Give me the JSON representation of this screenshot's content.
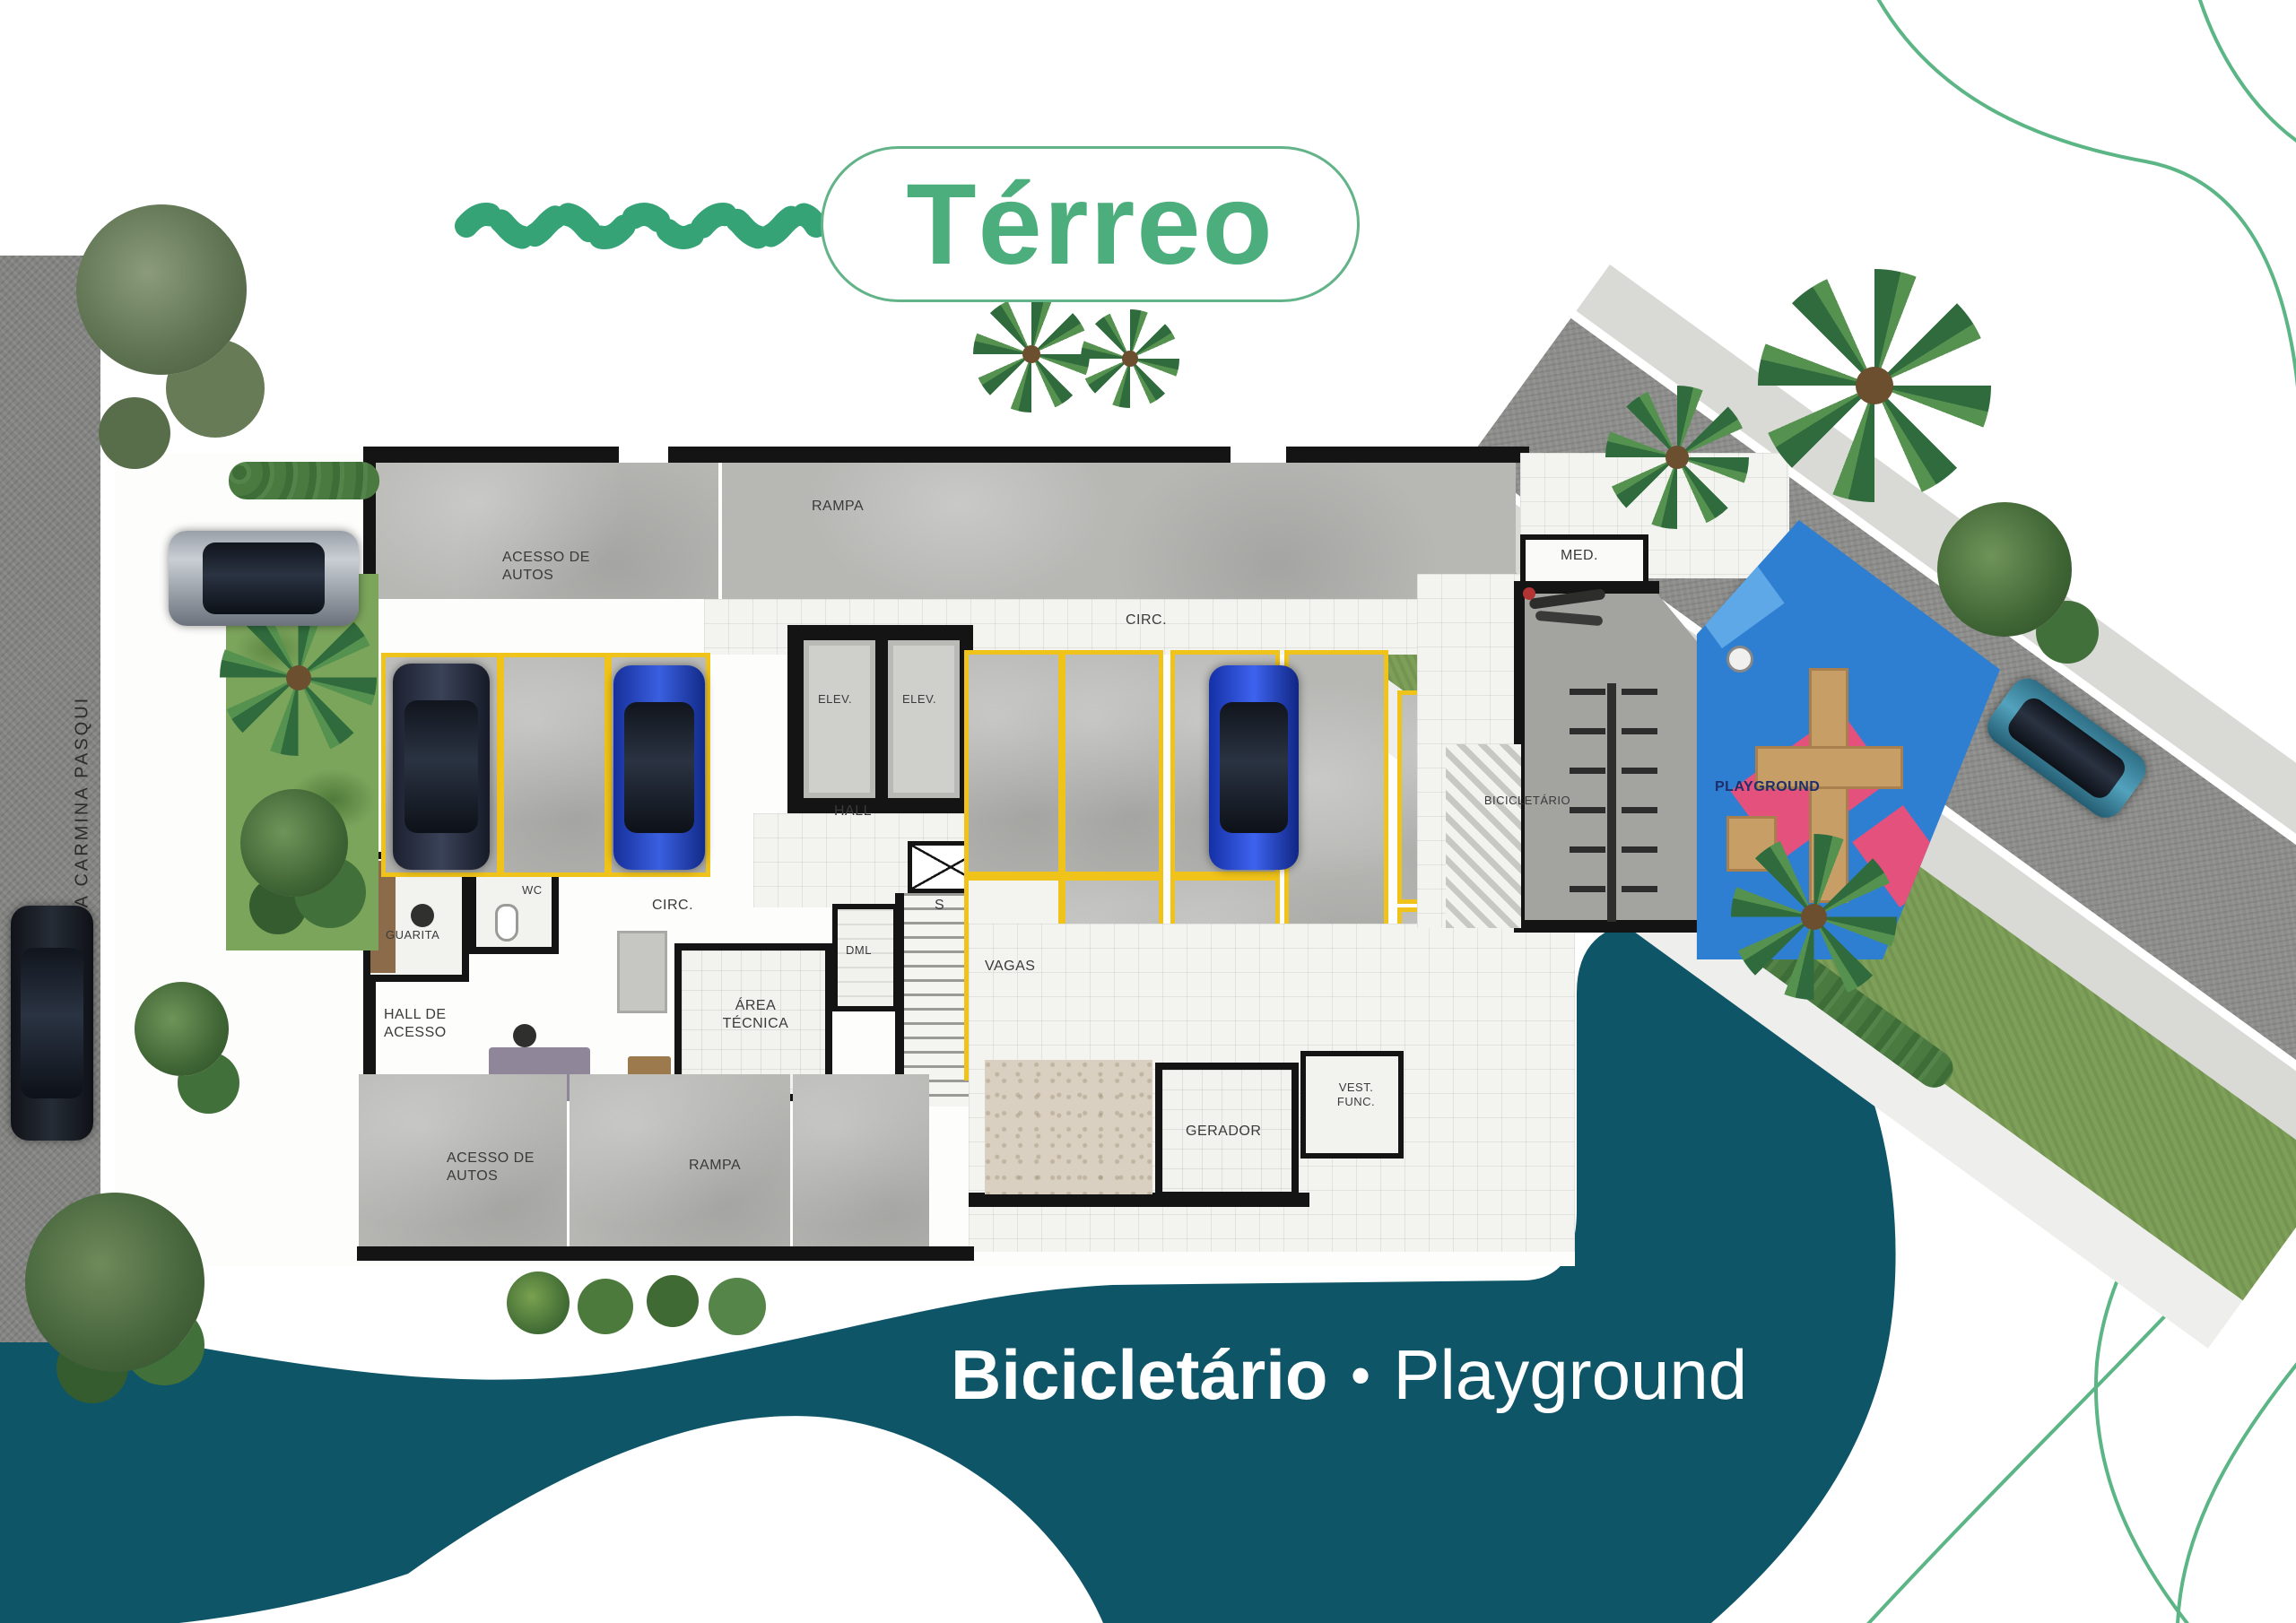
{
  "title": {
    "text": "Térreo"
  },
  "caption": {
    "bold": "Bicicletário",
    "separator": "•",
    "regular": "Playground"
  },
  "streets": {
    "left": "RUA CARMINA PASQUI",
    "right": "RUA SILVIO RODINI"
  },
  "plan": {
    "labels": {
      "acesso_autos": "ACESSO DE AUTOS",
      "rampa": "RAMPA",
      "circ": "CIRC.",
      "elev": "ELEV.",
      "hall": "HALL",
      "med": "MED.",
      "bicicletario": "BICICLETÁRIO",
      "playground": "PLAYGROUND",
      "guarita": "GUARITA",
      "wc": "WC",
      "dml": "DML",
      "stairs": "S",
      "vagas": "VAGAS",
      "hall_de_acesso": "HALL DE ACESSO",
      "area_tecnica": "ÁREA TÉCNICA",
      "gerador": "GERADOR",
      "vest_func": "VEST. FUNC."
    }
  },
  "colors": {
    "accent_green": "#4dae7d",
    "teal_wave": "#0e5568",
    "stall_yellow": "#f0c31a",
    "playground_blue": "#2e7fd2",
    "playground_pink": "#e4517c",
    "caption_text": "#ffffff"
  }
}
